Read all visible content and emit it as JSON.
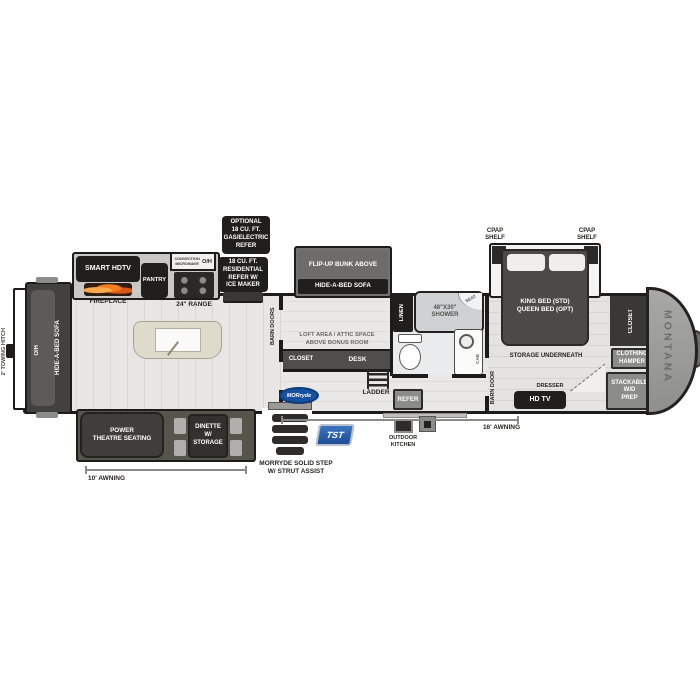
{
  "labels": {
    "towing_hitch": "2' TOWING HITCH",
    "rear_overhead": "O/H",
    "rear_sofa": "HIDE-A-BED SOFA",
    "smart_hdtv": "SMART HDTV",
    "fireplace": "FIREPLACE",
    "pantry": "PANTRY",
    "convection_microwave": "CONVECTION MICROWAVE",
    "overhead": "O/H",
    "range": "24\" RANGE",
    "optional_refer": "OPTIONAL\n18 CU. FT.\nGAS/ELECTRIC\nREFER",
    "residential_refer": "18 CU. FT.\nRESIDENTIAL\nREFER W/\nICE MAKER",
    "flip_up_bunk": "FLIP-UP BUNK ABOVE",
    "bunk_sofa": "HIDE-A-BED SOFA",
    "barn_doors": "BARN DOORS",
    "loft_area": "LOFT AREA / ATTIC SPACE\nABOVE BONUS ROOM",
    "bonus_closet": "CLOSET",
    "desk": "DESK",
    "linen": "LINEN",
    "shower": "48\"X30\"\nSHOWER",
    "shower_seat": "SEAT",
    "vanity_cab": "CAB",
    "barn_door": "BARN DOOR",
    "cpap_shelf_left": "CPAP\nSHELF",
    "cpap_shelf_right": "CPAP\nSHELF",
    "king_bed": "KING BED (STD)\nQUEEN BED (OPT)",
    "storage_underneath": "STORAGE UNDERNEATH",
    "bedroom_closet": "CLOSET",
    "clothing_hamper": "CLOTHING\nHAMPER",
    "stackable_wd": "STACKABLE\nW/D\nPREP",
    "dresser": "DRESSER",
    "hd_tv": "HD TV",
    "brand": "MONTANA",
    "theatre_seating": "POWER\nTHEATRE SEATING",
    "dinette": "DINETTE\nW/ STORAGE",
    "awning_10": "10'  AWNING",
    "morryde_step": "MORRYDE SOLID STEP\nW/ STRUT ASSIST",
    "morryde_logo": "MORryde",
    "tst": "TST",
    "ladder": "LADDER",
    "outdoor_refer": "REFER",
    "outdoor_kitchen": "OUTDOOR\nKITCHEN",
    "awning_16": "16'  AWNING"
  },
  "colors": {
    "wall": "#1d1c1a",
    "label_box": "#211f1e",
    "gray_box": "#8c8c8a",
    "slide_olive": "#56554b",
    "island": "#dedacc",
    "flame_orange": "#e06a1a",
    "morryde_blue": "#15519e",
    "tst_blue": "#2a63af"
  }
}
